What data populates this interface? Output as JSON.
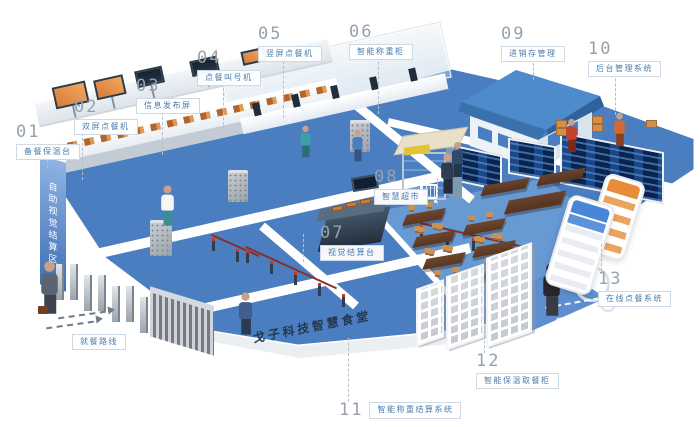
{
  "scene": {
    "brand_title": "戈子科技智慧食堂",
    "zones": {
      "visual_checkout_wall": "自助视觉结算区",
      "weighing_checkout_banner": "自助称重结算区",
      "dining_route": "就餐路线"
    }
  },
  "callouts": [
    {
      "num": "01",
      "label": "备餐保温台"
    },
    {
      "num": "02",
      "label": "双屏点餐机"
    },
    {
      "num": "03",
      "label": "信息发布屏"
    },
    {
      "num": "04",
      "label": "点餐叫号机"
    },
    {
      "num": "05",
      "label": "竖屏点餐机"
    },
    {
      "num": "06",
      "label": "智能称重柜"
    },
    {
      "num": "07",
      "label": "视觉结算台"
    },
    {
      "num": "08",
      "label": "智慧超市"
    },
    {
      "num": "09",
      "label": "进销存管理"
    },
    {
      "num": "10",
      "label": "后台管理系统"
    },
    {
      "num": "11",
      "label": "智能称重结算系统"
    },
    {
      "num": "12",
      "label": "智能保温取餐柜"
    },
    {
      "num": "13",
      "label": "在线点餐系统"
    }
  ],
  "colors": {
    "floor_blue": "#4a7ec1",
    "floor_blue_light": "#6799d3",
    "floor_blue_soft": "#5d8fcf",
    "label_text_blue": "#4a7cab",
    "label_border": "#cdd9e4",
    "number_gray": "#96a1ad",
    "title_navy": "#23374d",
    "roof_blue": "#4e8bca",
    "dashboard_navy": "#0c2350",
    "table_brown": "#6d462c",
    "accent_orange": "#d98a4a"
  }
}
